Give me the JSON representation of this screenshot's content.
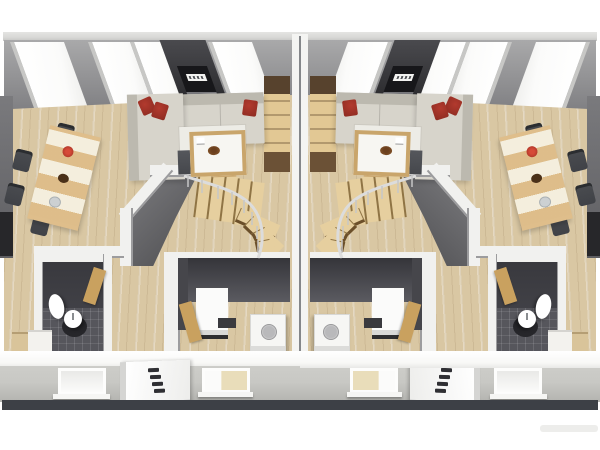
{
  "meta": {
    "description": "3D isometric cutaway rendering of the upper floor of a semi-detached duplex house with two mirrored apartments"
  },
  "colors": {
    "background": "#ffffff",
    "roof_edge": "#d8d8d6",
    "roof_wall_top": "#a9a9aa",
    "roof_wall_bottom": "#808083",
    "skylight": "#fbfbfa",
    "tv_panel": "#2c2c2f",
    "wood_floor": "#d9c7a3",
    "party_wall": "#f4f4f2",
    "inner_wall": "#f1f1ef",
    "wall_edge": "#9c9c9e",
    "sofa_base": "#d7d4cb",
    "sofa_back": "#bcb9af",
    "cushion_red": "#b23a2e",
    "rug": "#edece6",
    "coffee_frame": "#c9a56b",
    "lowboard": "#45474c",
    "table_wood": "#dfbe8b",
    "runner_cream": "#f4eedd",
    "chair_dark": "#404247",
    "stair_wood": "#e6cf9f",
    "stair_edge": "#8f7445",
    "winder_edge": "#6b4f2a",
    "room_dark": "#48484e",
    "tile_floor": "#56565c",
    "fixture_white": "#ffffff",
    "appliance_white": "#f6f6f4",
    "door_wood": "#c9a15f",
    "shelf_wood": "#e2c894",
    "shelf_dark": "#57422d",
    "cut_band": "#f8f8f6",
    "facade": "#c8c8c4",
    "facade_dark": "#b3b3af",
    "window_lit": "#e9ddba",
    "base_band": "#3d4046",
    "railing": "#d9d9d9",
    "void_dark": "#4b4b4e",
    "void_light": "#7d7d80"
  },
  "scene": {
    "units": [
      {
        "id": "left-apartment"
      },
      {
        "id": "right-apartment",
        "mirrored": true
      }
    ],
    "per_unit_inventory": {
      "roof_windows": 4,
      "wall_tv_with_brand_label": 1,
      "living_room": [
        "corner-sofa",
        "red-cushions-x3",
        "coffee-table-with-bowl",
        "white-rug",
        "tv-lowboard",
        "wood-side-table",
        "tall-shelf-unit"
      ],
      "dining_area": [
        "wood-table-with-striped-runner",
        "red-plate",
        "dark-bowl",
        "gray-plate",
        "dark-chairs-x6"
      ],
      "staircase": [
        "straight-flight-treads-x5",
        "winder-treads-x4",
        "metal-railing",
        "angled-stairwell-wall"
      ],
      "bathroom": [
        "dark-tile-floor",
        "pedestal-sink",
        "round-washbasin",
        "floor-mat",
        "wood-door"
      ],
      "utility_room": [
        "tall-fridge-cabinet",
        "dark-counter",
        "washing-machine",
        "wood-door"
      ],
      "hallway_furniture": [
        "wood-cabinet",
        "white-cabinet"
      ],
      "ground_floor_facade": [
        "window",
        "entrance-door-with-4-lites",
        "window"
      ]
    }
  }
}
